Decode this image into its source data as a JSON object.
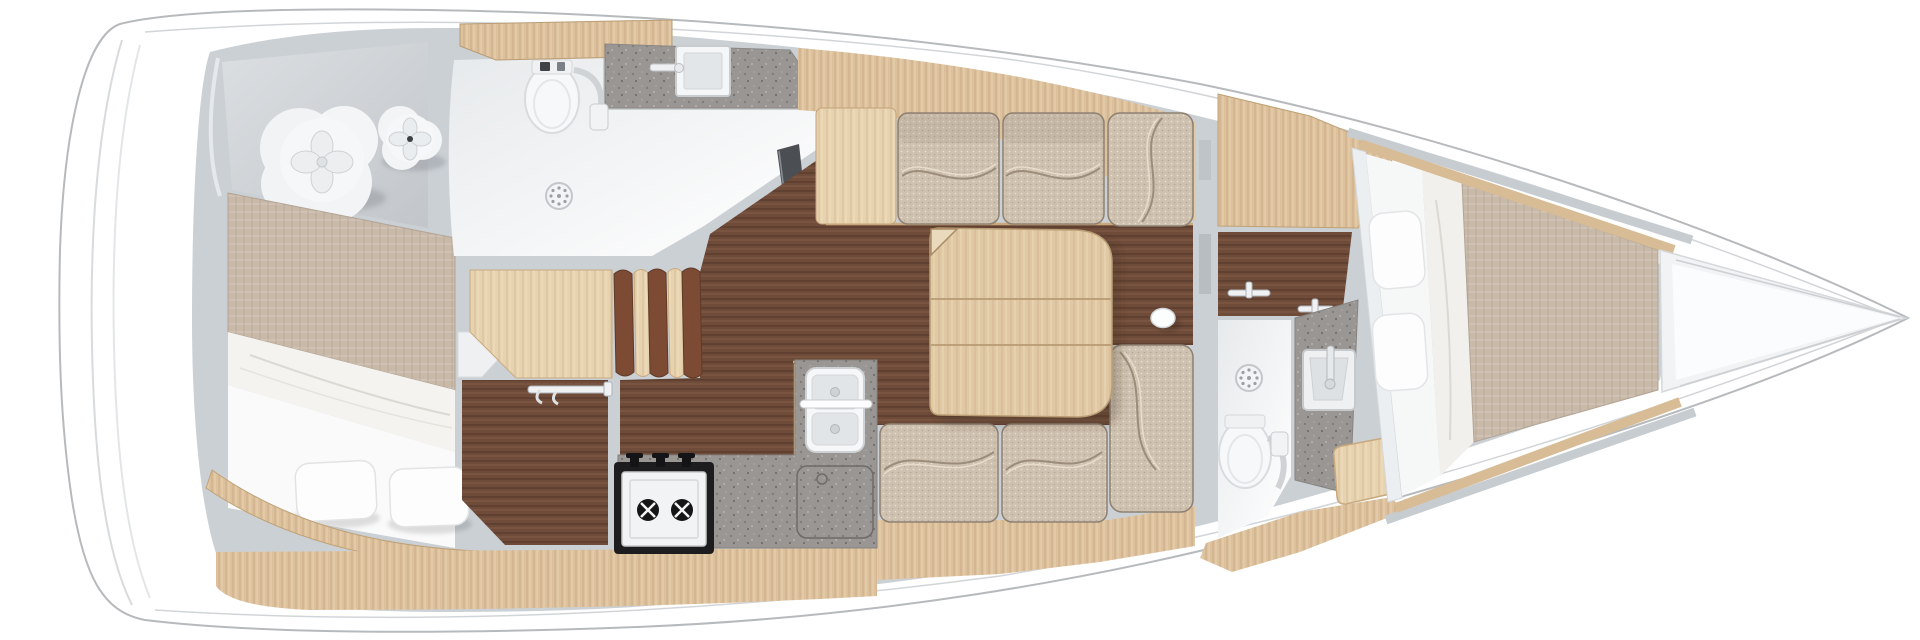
{
  "palette": {
    "page_bg": "#ffffff",
    "hull_white": "#ffffff",
    "hull_outline": "#b7babd",
    "deck_line": "#d2d5d8",
    "wall_gray": "#cbd0d5",
    "wall_light": "#e9ecee",
    "floor_walnut": "#6f4b39",
    "wood_light": "#dcc19c",
    "wood_pale": "#e6d2ae",
    "wood_table": "#dfc8a3",
    "wood_trim": "#d7bc95",
    "linen_beige": "#c8b9a9",
    "fabric_beige": "#cfc1b0",
    "granite_gray": "#999693",
    "bath_floor_light": "#eceef0",
    "soft_white": "#f6f7f8",
    "chrome": "#eff1f2",
    "dark_panel": "#4b4e53",
    "stove_black": "#1d1d1f",
    "cushion_edge": "#8f8172",
    "stern_floor": "#cfd3d7",
    "white_bedding": "#f4f3f0"
  },
  "regions": {
    "aft_deck_lounge": {
      "poufs": 2
    },
    "aft_cabin": {
      "pillows": 2,
      "berth_sections": [
        "mattress",
        "blanket",
        "sheet"
      ]
    },
    "aft_head": {
      "fixtures": [
        "toilet",
        "sink",
        "shower-drain",
        "mirror-panel",
        "shelf"
      ]
    },
    "companionway": {
      "steps": 3
    },
    "wardrobe": {
      "fixtures": [
        "clothes-rail"
      ]
    },
    "galley": {
      "fixtures": [
        "two-burner-stove",
        "double-sink",
        "access-hatch",
        "counter"
      ]
    },
    "salon": {
      "settee_cushions": 6,
      "table_leaves": 3,
      "fixtures": [
        "folding-table",
        "compression-post-cap"
      ]
    },
    "fwd_head": {
      "fixtures": [
        "toilet",
        "sink",
        "shower-drain",
        "towel-rail",
        "towel-rail",
        "seat"
      ]
    },
    "fwd_cabin": {
      "pillows": 2,
      "berth_sections": [
        "sheet",
        "blanket",
        "mattress"
      ]
    },
    "bow_locker": {
      "fixtures": []
    }
  }
}
